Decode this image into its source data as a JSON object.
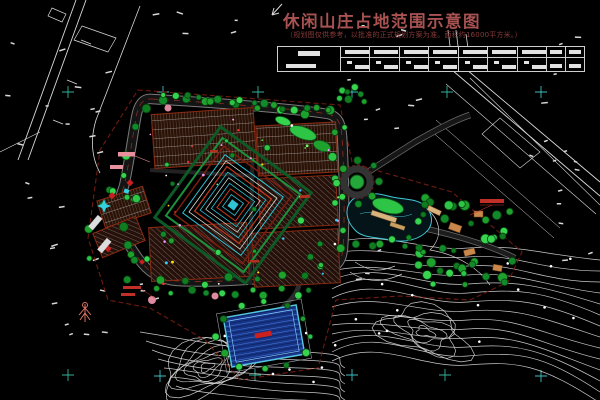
{
  "title": {
    "text": "休闲山庄占地范围示意图"
  },
  "subtitle": {
    "text": "（规划图仅供参考，以批准的正式规划方案为准。面积约16000平方米。）"
  },
  "legend": {
    "label_section_width": 62,
    "wide_columns": 7,
    "narrow_columns": 2
  },
  "colors": {
    "background": "#000000",
    "title_red": "#a85252",
    "subtitle_red": "#8a3a3a",
    "contour_white": "#d9d9d9",
    "tree_greens": [
      "#1fa12e",
      "#2ec446",
      "#0f7d1f",
      "#37d44f",
      "#128a2a"
    ],
    "tree_outline": "#073f10",
    "road_dark": "#141414",
    "road_edge": "#7a7a7a",
    "pool_fill": "#17368a",
    "pool_edge": "#55c8e0",
    "boundary_red": "#7a1e10",
    "hatch_base": "#2a1206",
    "survey_cross_teal": "#35b39a",
    "survey_cross_cyan": "#3ec1c1",
    "annotation_red": "#c03028",
    "annotation_pink": "#e8909e",
    "building_orange": "#c9874c",
    "mandala_cyan": "#2fc3d4",
    "mandala_green": "#1c913c",
    "mandala_red": "#c23b1f"
  }
}
